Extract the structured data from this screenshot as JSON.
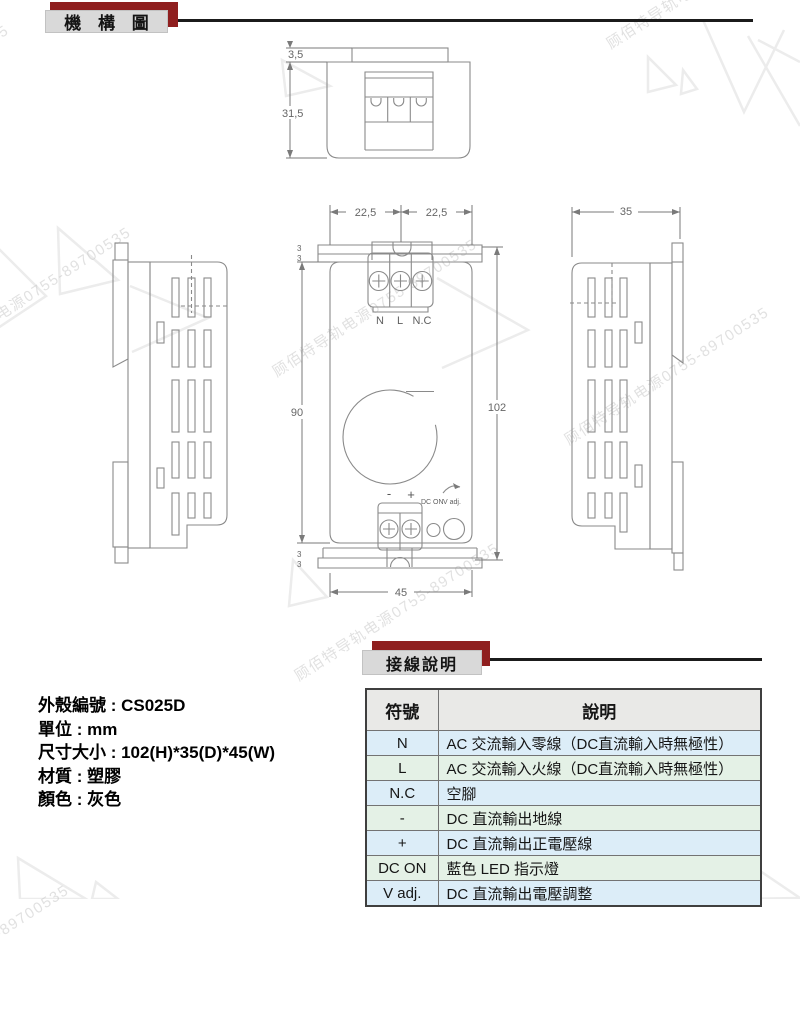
{
  "header": {
    "title": "機 構 圖"
  },
  "wiring_header": {
    "title": "接線說明"
  },
  "watermark": {
    "text": "顾佰特导轨电源0755-89700535"
  },
  "drawing": {
    "top_view": {
      "dim_tab_height": "3,5",
      "dim_body_depth": "31,5"
    },
    "front_view": {
      "dim_half_left": "22,5",
      "dim_half_right": "22,5",
      "dim_body_height": "90",
      "dim_total_height": "102",
      "dim_width": "45",
      "dim_flange_top_1": "3",
      "dim_flange_top_2": "3",
      "dim_flange_bottom_1": "3",
      "dim_flange_bottom_2": "3",
      "terminal_labels": {
        "n": "N",
        "l": "L",
        "nc": "N.C"
      },
      "output_labels": {
        "minus": "-",
        "plus": "+"
      },
      "indicator_labels": {
        "led": "DC ON",
        "adjust": "V adj."
      }
    },
    "right_view": {
      "dim_depth": "35"
    }
  },
  "specs": {
    "lines": [
      "外殼編號 : CS025D",
      "單位 : mm",
      "尺寸大小 : 102(H)*35(D)*45(W)",
      "材質 : 塑膠",
      "顏色 : 灰色"
    ]
  },
  "wiring_table": {
    "headers": [
      "符號",
      "說明"
    ],
    "rows": [
      {
        "symbol": "N",
        "desc": "AC 交流輸入零線（DC直流輸入時無極性）"
      },
      {
        "symbol": "L",
        "desc": "AC 交流輸入火線（DC直流輸入時無極性）"
      },
      {
        "symbol": "N.C",
        "desc": "空腳"
      },
      {
        "symbol": "-",
        "desc": "DC 直流輸出地線"
      },
      {
        "symbol": "+",
        "desc": "DC 直流輸出正電壓線"
      },
      {
        "symbol": "DC ON",
        "desc": "藍色 LED 指示燈"
      },
      {
        "symbol": "V adj.",
        "desc": "DC 直流輸出電壓調整"
      }
    ]
  },
  "colors": {
    "banner_red": "#8f1f1f",
    "banner_gray": "#d9d9d9",
    "rule_black": "#1b1b1b",
    "row_blue": "#dcedf8",
    "row_green": "#e4f1e6",
    "table_header_gray": "#e9e9e7",
    "drawing_line_gray": "#8a8a8a"
  }
}
